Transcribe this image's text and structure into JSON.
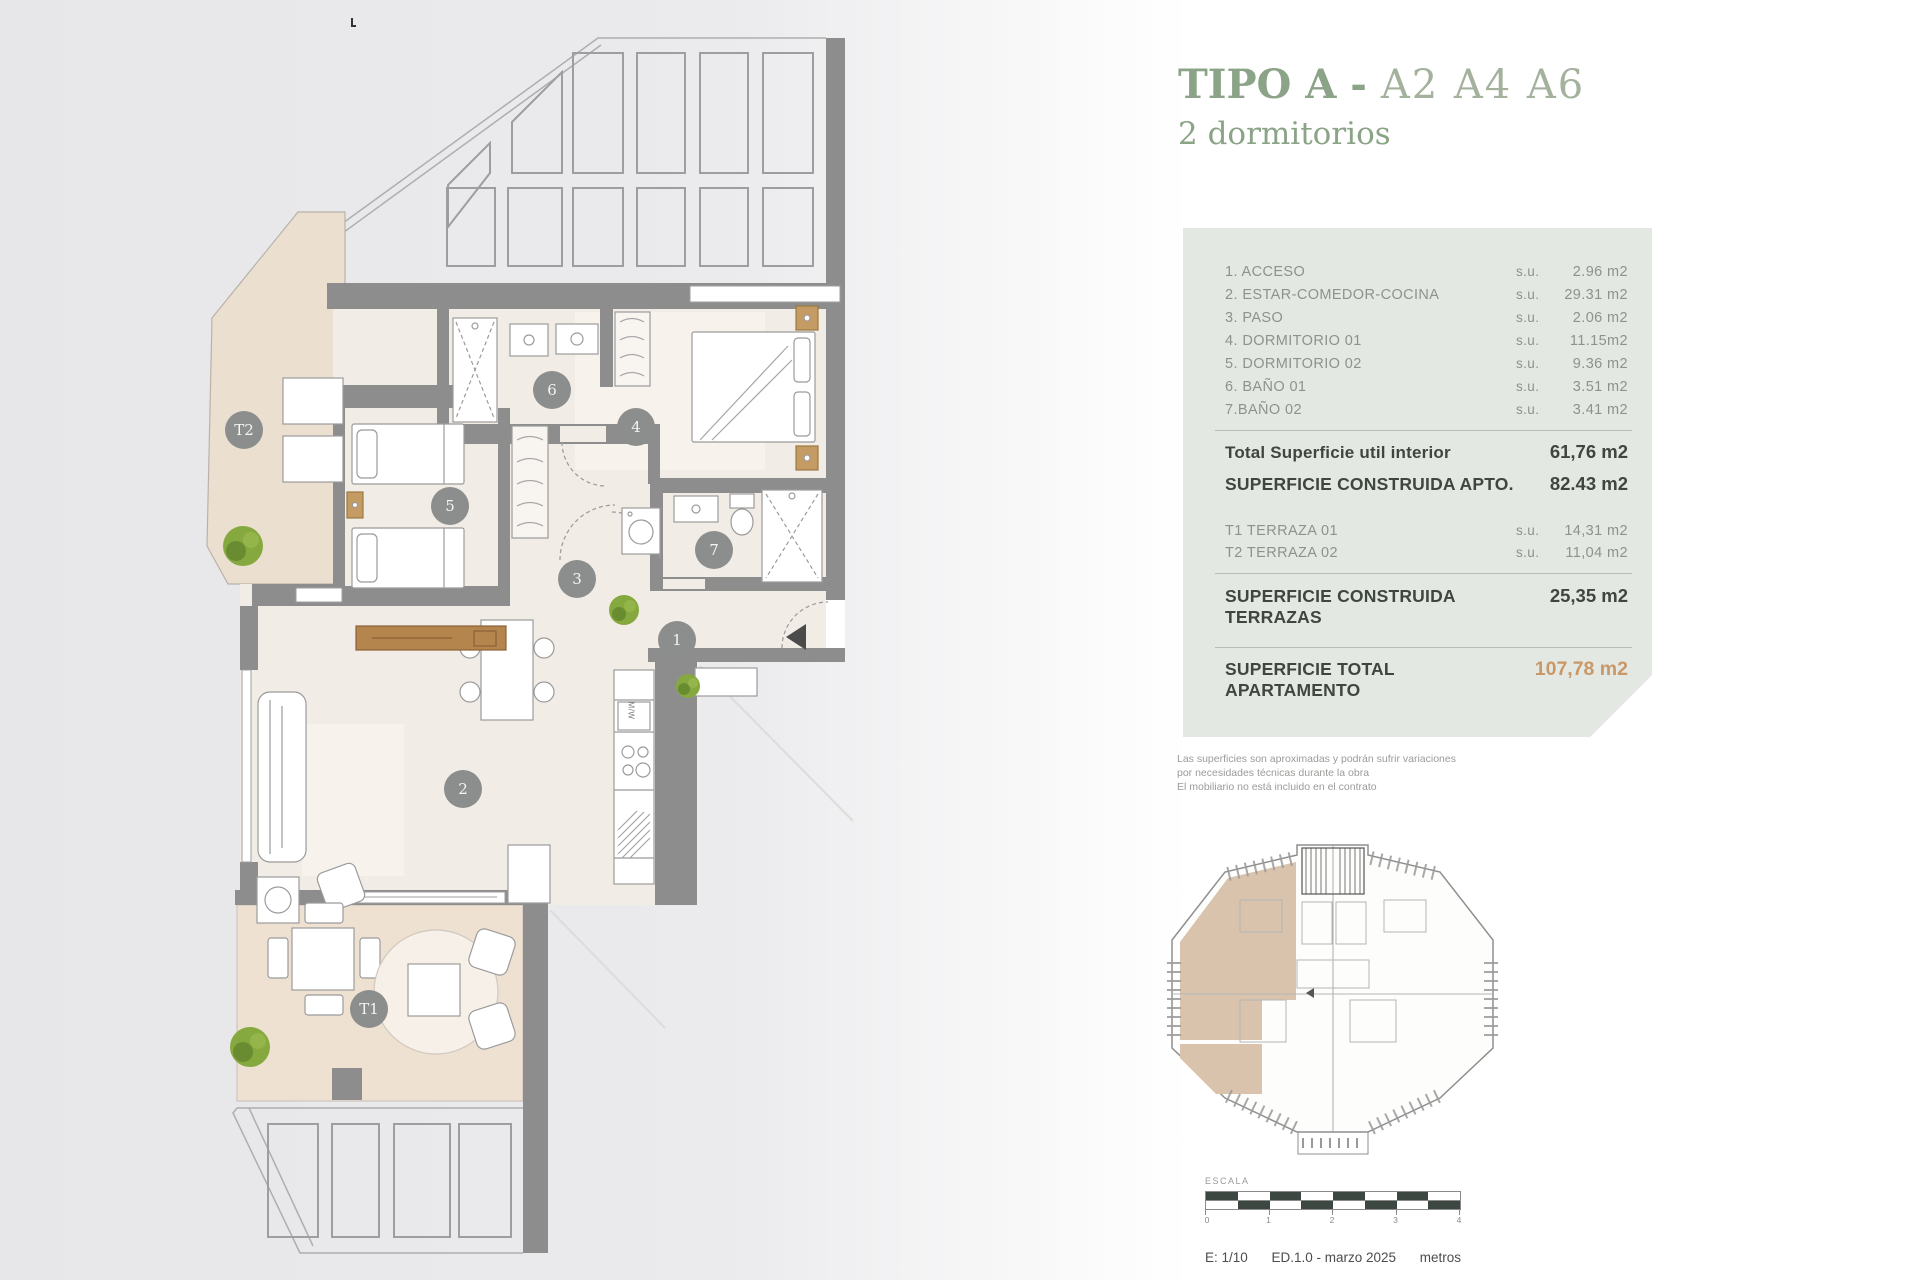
{
  "header": {
    "title": "TIPO A",
    "separator": " - ",
    "units": "A2 A4 A6",
    "subtitle": "2 dormitorios"
  },
  "panel": {
    "rooms": [
      {
        "label": "1. ACCESO",
        "su": "s.u.",
        "value": "2.96 m2"
      },
      {
        "label": "2. ESTAR-COMEDOR-COCINA",
        "su": "s.u.",
        "value": "29.31 m2"
      },
      {
        "label": "3. PASO",
        "su": "s.u.",
        "value": "2.06 m2"
      },
      {
        "label": "4. DORMITORIO 01",
        "su": "s.u.",
        "value": "11.15m2"
      },
      {
        "label": "5. DORMITORIO 02",
        "su": "s.u.",
        "value": "9.36 m2"
      },
      {
        "label": "6. BAÑO 01",
        "su": "s.u.",
        "value": "3.51 m2"
      },
      {
        "label": "7.BAÑO 02",
        "su": "s.u.",
        "value": "3.41 m2"
      }
    ],
    "total_interior": {
      "label": "Total Superficie util interior",
      "value": "61,76 m2"
    },
    "construida_apto": {
      "label": "SUPERFICIE CONSTRUIDA APTO.",
      "value": "82.43 m2"
    },
    "terrazas": [
      {
        "label": "T1 TERRAZA 01",
        "su": "s.u.",
        "value": "14,31 m2"
      },
      {
        "label": "T2 TERRAZA 02",
        "su": "s.u.",
        "value": "11,04 m2"
      }
    ],
    "construida_terrazas": {
      "label": "SUPERFICIE CONSTRUIDA\nTERRAZAS",
      "value": "25,35 m2"
    },
    "total_apartamento": {
      "label": "SUPERFICIE TOTAL\nAPARTAMENTO",
      "value": "107,78 m2"
    }
  },
  "disclaimer": {
    "line1": "Las superficies son aproximadas y podrán sufrir variaciones",
    "line2": "por necesidades técnicas durante la obra",
    "line3": "El mobiliario no está incluido en el contrato"
  },
  "scale": {
    "label": "ESCALA",
    "ticks": [
      "0",
      "1",
      "2",
      "3",
      "4"
    ],
    "ratio": "E: 1/10",
    "edition": "ED.1.0 - marzo 2025",
    "unit": "metros"
  },
  "plan": {
    "markers": {
      "t2": "T2",
      "b6": "6",
      "b5": "5",
      "b4": "4",
      "p3": "3",
      "b7": "7",
      "e1": "1",
      "l2": "2",
      "t1": "T1"
    },
    "kitchen_label": "M/W"
  },
  "colors": {
    "accent_green": "#8ba386",
    "accent_muted": "#a4b29d",
    "total_orange": "#c99868",
    "panel_bg": "#e4e8e2",
    "wall_gray": "#8d8d8d",
    "terrace_beige": "#ebdfd0",
    "floor_beige": "#f2ece6",
    "scale_dark": "#3d4742"
  }
}
